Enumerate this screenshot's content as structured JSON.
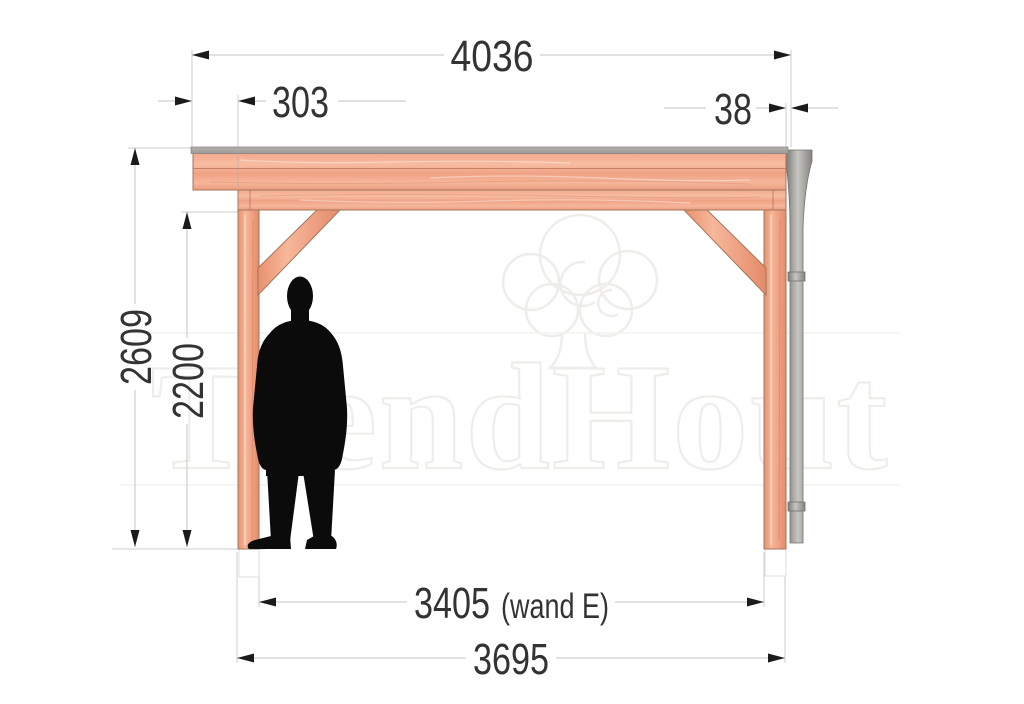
{
  "drawing": {
    "title": "Veranda zijaanzicht maatvoering",
    "watermark": {
      "brand": "TrendHout",
      "logo_icon": "tree-cloud-icon"
    },
    "dimensions": {
      "roof_total_width": {
        "label": "4036"
      },
      "left_overhang": {
        "label": "303"
      },
      "right_overhang": {
        "label": "38"
      },
      "total_height": {
        "label": "2609"
      },
      "clear_height": {
        "label": "2200"
      },
      "wall_span": {
        "value": "3405",
        "suffix": "(wand E)"
      },
      "frame_total_width": {
        "label": "3695"
      }
    },
    "colors": {
      "wood_light": "#f8c3a6",
      "wood_mid": "#f2a88b",
      "wood_dark": "#e8946f",
      "roof_strip": "#a9a7a2",
      "gutter_pipe": "#9c9a96",
      "dimension_line": "#c6c6c6",
      "dimension_text": "#333333",
      "silhouette": "#0b0b0b",
      "watermark": "#efede9"
    }
  }
}
